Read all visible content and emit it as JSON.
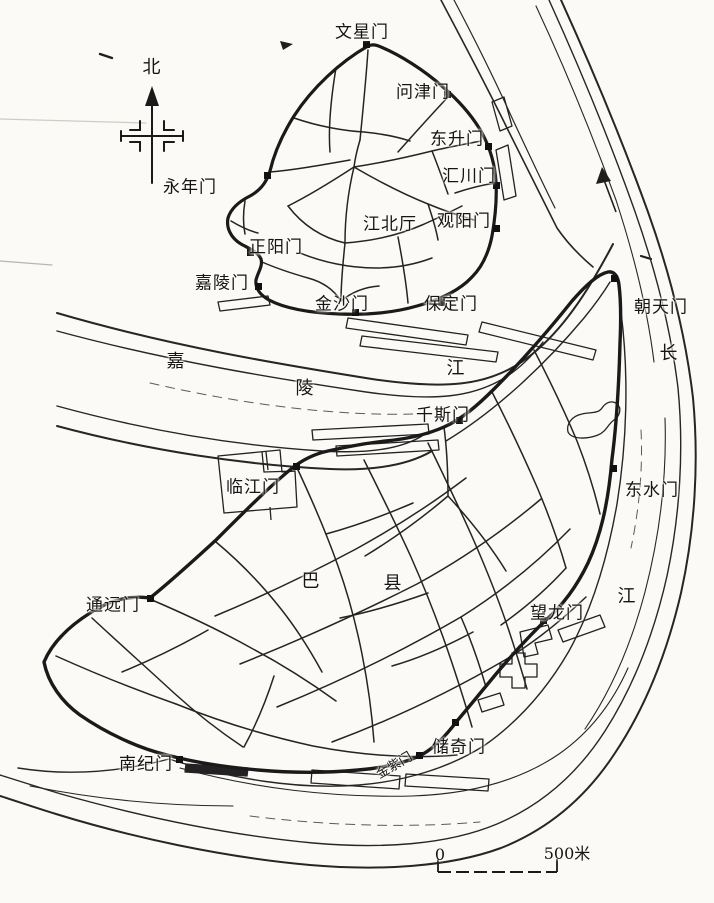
{
  "figure": {
    "kind": "historical-city-map-scan",
    "depicts": "old walled cities of Chongqing (Ba County) and Jiangbei Ting at the Jialing-Yangtze confluence"
  },
  "colors": {
    "ink": "#1f1f1f",
    "paper": "#fbfaf7"
  },
  "compass": {
    "label": "北"
  },
  "flow_arrow": {
    "direction": "northeast"
  },
  "scale_bar": {
    "zero": "0",
    "distance": "500米"
  },
  "map_labels": [
    {
      "name": "wenxing-gate",
      "text": "文星门"
    },
    {
      "name": "north-label",
      "text": "北"
    },
    {
      "name": "wenjin-gate",
      "text": "问津门"
    },
    {
      "name": "dongsheng-gate",
      "text": "东升门"
    },
    {
      "name": "huichuan-gate",
      "text": "汇川门"
    },
    {
      "name": "yongnian-gate",
      "text": "永年门"
    },
    {
      "name": "guanyang-gate",
      "text": "观阳门"
    },
    {
      "name": "jiangbei-ting",
      "text": "江北厅"
    },
    {
      "name": "zhengyang-gate",
      "text": "正阳门"
    },
    {
      "name": "jialing-gate",
      "text": "嘉陵门"
    },
    {
      "name": "jinsha-gate",
      "text": "金沙门"
    },
    {
      "name": "baoding-gate",
      "text": "保定门"
    },
    {
      "name": "chaotian-gate",
      "text": "朝天门"
    },
    {
      "name": "jialing-river-char-1",
      "text": "嘉"
    },
    {
      "name": "jialing-river-char-2",
      "text": "陵"
    },
    {
      "name": "jialing-river-char-3",
      "text": "江"
    },
    {
      "name": "yangtze-river-char-1",
      "text": "长"
    },
    {
      "name": "qiansi-gate",
      "text": "千斯门"
    },
    {
      "name": "linjiang-gate",
      "text": "临江门"
    },
    {
      "name": "dongshui-gate",
      "text": "东水门"
    },
    {
      "name": "tongyuan-gate",
      "text": "通远门"
    },
    {
      "name": "ba-county-char-1",
      "text": "巴"
    },
    {
      "name": "ba-county-char-2",
      "text": "县"
    },
    {
      "name": "wanglong-gate",
      "text": "望龙门"
    },
    {
      "name": "yangtze-river-char-2",
      "text": "江"
    },
    {
      "name": "chuqi-gate",
      "text": "储奇门"
    },
    {
      "name": "jinzi-gate",
      "text": "金紫门"
    },
    {
      "name": "nanji-gate",
      "text": "南纪门"
    },
    {
      "name": "scale-zero",
      "text": "0"
    },
    {
      "name": "scale-distance",
      "text": "500米"
    }
  ]
}
